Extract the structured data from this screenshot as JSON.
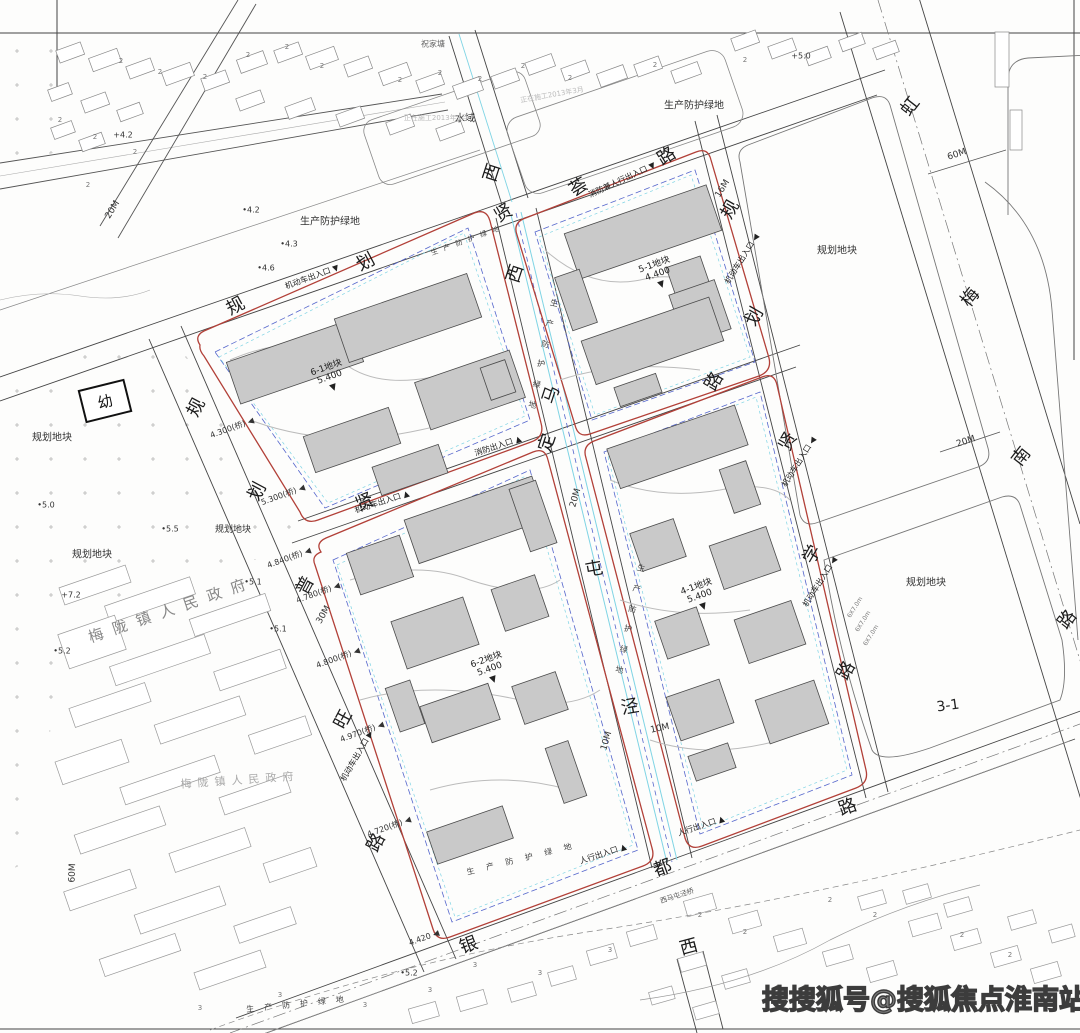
{
  "page": {
    "width": 1080,
    "height": 1033,
    "background": "#fdfdfc"
  },
  "colors": {
    "road_line": "#444444",
    "minor_line": "#999999",
    "plot_red_line": "#b24038",
    "red_dashed": "#8b2e2e",
    "blue_dashed": "#5566cc",
    "cyan_water": "#7fd4e4",
    "building_fill": "#c9c9c9",
    "building_stroke": "#4a4a4a",
    "hatch": "#b5b5b5",
    "watermark_stroke": "#3c3c3c"
  },
  "watermark": {
    "text": "搜搜狐号@搜狐焦点淮南站"
  },
  "kindergarten": {
    "label": "幼"
  },
  "roads": [
    {
      "name": "规划贤荟路",
      "chars": [
        {
          "t": "规",
          "x": 236,
          "y": 307,
          "r": -28
        },
        {
          "t": "划",
          "x": 366,
          "y": 263,
          "r": -28
        },
        {
          "t": "贤",
          "x": 504,
          "y": 214,
          "r": -30
        },
        {
          "t": "荟",
          "x": 579,
          "y": 188,
          "r": -32
        },
        {
          "t": "路",
          "x": 667,
          "y": 157,
          "r": -32
        }
      ]
    },
    {
      "name": "贤定路",
      "chars": [
        {
          "t": "贤",
          "x": 365,
          "y": 503,
          "r": -22
        },
        {
          "t": "定",
          "x": 548,
          "y": 443,
          "r": -72
        },
        {
          "t": "路",
          "x": 715,
          "y": 382,
          "r": -60
        }
      ]
    },
    {
      "name": "规划贤学路",
      "chars": [
        {
          "t": "规",
          "x": 731,
          "y": 210,
          "r": -60
        },
        {
          "t": "划",
          "x": 755,
          "y": 317,
          "r": -60
        },
        {
          "t": "贤",
          "x": 789,
          "y": 442,
          "r": -60
        },
        {
          "t": "学",
          "x": 813,
          "y": 555,
          "r": -60
        },
        {
          "t": "路",
          "x": 847,
          "y": 671,
          "r": -60
        }
      ]
    },
    {
      "name": "规划普旺路",
      "chars": [
        {
          "t": "规",
          "x": 197,
          "y": 408,
          "r": -62
        },
        {
          "t": "划",
          "x": 258,
          "y": 492,
          "r": -62
        },
        {
          "t": "普",
          "x": 306,
          "y": 586,
          "r": -62
        },
        {
          "t": "旺",
          "x": 344,
          "y": 720,
          "r": -62
        },
        {
          "t": "路",
          "x": 377,
          "y": 843,
          "r": -62
        }
      ]
    },
    {
      "name": "银都路",
      "chars": [
        {
          "t": "银",
          "x": 469,
          "y": 946,
          "r": -20
        },
        {
          "t": "都",
          "x": 663,
          "y": 869,
          "r": -20
        },
        {
          "t": "路",
          "x": 848,
          "y": 808,
          "r": -20
        }
      ]
    },
    {
      "name": "虹梅南路",
      "chars": [
        {
          "t": "虹",
          "x": 911,
          "y": 107,
          "r": -52
        },
        {
          "t": "梅",
          "x": 971,
          "y": 298,
          "r": -52
        },
        {
          "t": "南",
          "x": 1022,
          "y": 457,
          "r": -52
        },
        {
          "t": "路",
          "x": 1068,
          "y": 620,
          "r": -52
        }
      ]
    },
    {
      "name": "西马屯泾(河道)",
      "chars": [
        {
          "t": "西",
          "x": 493,
          "y": 173,
          "r": -72
        },
        {
          "t": "西",
          "x": 516,
          "y": 274,
          "r": -72
        },
        {
          "t": "马",
          "x": 552,
          "y": 395,
          "r": -72
        },
        {
          "t": "屯",
          "x": 594,
          "y": 570,
          "r": -10
        },
        {
          "t": "泾",
          "x": 630,
          "y": 708,
          "r": -10
        },
        {
          "t": "西",
          "x": 689,
          "y": 948,
          "r": -15
        }
      ]
    }
  ],
  "plot_markers": [
    {
      "plot": "6-1地块",
      "elev": "5.400",
      "x": 330,
      "y": 378,
      "r": -20
    },
    {
      "plot": "5-1地块",
      "elev": "4.400",
      "x": 658,
      "y": 275,
      "r": -20
    },
    {
      "plot": "6-2地块",
      "elev": "5.400",
      "x": 490,
      "y": 670,
      "r": -20
    },
    {
      "plot": "4-1地块",
      "elev": "5.400",
      "x": 700,
      "y": 597,
      "r": -20
    }
  ],
  "dims": [
    {
      "t": "20M",
      "x": 113,
      "y": 210,
      "r": -58
    },
    {
      "t": "16M",
      "x": 723,
      "y": 189,
      "r": -58
    },
    {
      "t": "60M",
      "x": 957,
      "y": 155,
      "r": -18
    },
    {
      "t": "20M",
      "x": 966,
      "y": 442,
      "r": -18
    },
    {
      "t": "30M",
      "x": 324,
      "y": 615,
      "r": -60
    },
    {
      "t": "20M",
      "x": 576,
      "y": 498,
      "r": -74
    },
    {
      "t": "10M",
      "x": 607,
      "y": 741,
      "r": -74
    },
    {
      "t": "10M",
      "x": 660,
      "y": 729,
      "r": -12
    },
    {
      "t": "60M",
      "x": 73,
      "y": 873,
      "r": -88
    }
  ],
  "entrances": [
    {
      "t": "机动车出入口",
      "x": 312,
      "y": 277,
      "r": -20,
      "arrow": "▼"
    },
    {
      "t": "机动车出入口",
      "x": 382,
      "y": 502,
      "r": -18,
      "arrow": "▲"
    },
    {
      "t": "消防兼人行出入口",
      "x": 622,
      "y": 180,
      "r": -25,
      "arrow": "▼"
    },
    {
      "t": "机动车出入口",
      "x": 742,
      "y": 259,
      "r": -58,
      "arrow": "◀"
    },
    {
      "t": "机动车出入口",
      "x": 799,
      "y": 462,
      "r": -58,
      "arrow": "◀"
    },
    {
      "t": "机动车出入口",
      "x": 820,
      "y": 582,
      "r": -58,
      "arrow": "◀"
    },
    {
      "t": "机动车出入口",
      "x": 357,
      "y": 756,
      "r": -60,
      "arrow": "▶"
    },
    {
      "t": "消防出入口",
      "x": 498,
      "y": 446,
      "r": -18,
      "arrow": "▲"
    },
    {
      "t": "人行出入口",
      "x": 603,
      "y": 854,
      "r": -18,
      "arrow": "▲"
    },
    {
      "t": "人行出入口",
      "x": 701,
      "y": 826,
      "r": -18,
      "arrow": "▲"
    }
  ],
  "elevations": [
    {
      "t": "+5.0",
      "x": 801,
      "y": 56,
      "r": 0
    },
    {
      "t": "+4.2",
      "x": 123,
      "y": 135,
      "r": 0
    },
    {
      "t": "•4.2",
      "x": 251,
      "y": 210,
      "r": 0
    },
    {
      "t": "•4.3",
      "x": 289,
      "y": 244,
      "r": 0
    },
    {
      "t": "•4.6",
      "x": 266,
      "y": 268,
      "r": 0
    },
    {
      "t": "•5.0",
      "x": 46,
      "y": 505,
      "r": 0
    },
    {
      "t": "•5.5",
      "x": 170,
      "y": 529,
      "r": 0
    },
    {
      "t": "+7.2",
      "x": 71,
      "y": 595,
      "r": 0
    },
    {
      "t": "•5.1",
      "x": 253,
      "y": 582,
      "r": 0
    },
    {
      "t": "•5.1",
      "x": 278,
      "y": 629,
      "r": 0
    },
    {
      "t": "•5.2",
      "x": 62,
      "y": 651,
      "r": 0
    },
    {
      "t": "•5.2",
      "x": 409,
      "y": 973,
      "r": 0
    },
    {
      "t": "4.300(桥)",
      "x": 232,
      "y": 428,
      "r": -20,
      "arrow": "◀"
    },
    {
      "t": "5.300(桥)",
      "x": 283,
      "y": 495,
      "r": -20,
      "arrow": "◀"
    },
    {
      "t": "4.840(桥)",
      "x": 289,
      "y": 558,
      "r": -20,
      "arrow": "◀"
    },
    {
      "t": "4.780(桥)",
      "x": 318,
      "y": 593,
      "r": -20,
      "arrow": "◀"
    },
    {
      "t": "4.800(桥)",
      "x": 338,
      "y": 658,
      "r": -20,
      "arrow": "◀"
    },
    {
      "t": "4.970(桥)",
      "x": 362,
      "y": 732,
      "r": -20,
      "arrow": "◀"
    },
    {
      "t": "4.720(桥)",
      "x": 389,
      "y": 827,
      "r": -20,
      "arrow": "◀"
    },
    {
      "t": "4.420",
      "x": 424,
      "y": 938,
      "r": -20,
      "arrow": "◀"
    }
  ],
  "areas": [
    {
      "t": "规划地块",
      "x": 52,
      "y": 438,
      "r": 0,
      "size": 10
    },
    {
      "t": "规划地块",
      "x": 92,
      "y": 555,
      "r": 0,
      "size": 10
    },
    {
      "t": "规划地块",
      "x": 233,
      "y": 530,
      "r": 0,
      "size": 9
    },
    {
      "t": "规划地块",
      "x": 837,
      "y": 251,
      "r": 0,
      "size": 10
    },
    {
      "t": "规划地块",
      "x": 926,
      "y": 583,
      "r": 0,
      "size": 10
    },
    {
      "t": "生产防护绿地",
      "x": 330,
      "y": 222,
      "r": 0,
      "size": 10
    },
    {
      "t": "生产防护绿地",
      "x": 694,
      "y": 106,
      "r": 0,
      "size": 10
    },
    {
      "t": "水域",
      "x": 465,
      "y": 119,
      "r": 0,
      "size": 10
    },
    {
      "t": "祝家塘",
      "x": 433,
      "y": 44,
      "r": 0,
      "size": 8,
      "color": "#666"
    },
    {
      "t": "正在施工2013年3月",
      "x": 436,
      "y": 118,
      "r": 0,
      "size": 7,
      "color": "#bbbbbb"
    },
    {
      "t": "正在施工2013年3月",
      "x": 552,
      "y": 95,
      "r": -10,
      "size": 7,
      "color": "#bbbbbb"
    },
    {
      "t": "梅陇镇人民政府",
      "x": 172,
      "y": 610,
      "r": -19,
      "size": 15,
      "color": "#888888",
      "ls": 10
    },
    {
      "t": "梅陇镇人民政府",
      "x": 240,
      "y": 781,
      "r": -4,
      "size": 11,
      "color": "#aaaaaa",
      "ls": 6
    },
    {
      "t": "西马屯泾桥",
      "x": 677,
      "y": 896,
      "r": -18,
      "size": 7,
      "color": "#555555"
    },
    {
      "t": "3-1",
      "x": 948,
      "y": 706,
      "r": -8,
      "size": 14,
      "color": "#222222"
    },
    {
      "t": "6X7.0m",
      "x": 856,
      "y": 608,
      "r": -58,
      "size": 6,
      "color": "#777777"
    },
    {
      "t": "6X7.0m",
      "x": 864,
      "y": 622,
      "r": -58,
      "size": 6,
      "color": "#777777"
    },
    {
      "t": "6X7.0m",
      "x": 872,
      "y": 636,
      "r": -58,
      "size": 6,
      "color": "#777777"
    }
  ],
  "green_strips": [
    {
      "t": "生产防护绿地",
      "x": 543,
      "y": 355,
      "r": 12,
      "v": true
    },
    {
      "t": "生产防护绿地",
      "x": 630,
      "y": 620,
      "r": 12,
      "v": true
    },
    {
      "t": "生产防护绿地",
      "x": 525,
      "y": 858,
      "r": -14,
      "ls": 12
    },
    {
      "t": "生产防护绿地",
      "x": 300,
      "y": 1004,
      "r": -6,
      "ls": 10
    },
    {
      "t": "生产防护绿地",
      "x": 468,
      "y": 240,
      "r": -20,
      "ls": 6,
      "size": 7
    }
  ],
  "storeys": [
    {
      "t": "2",
      "x": 121,
      "y": 61
    },
    {
      "t": "2",
      "x": 160,
      "y": 72
    },
    {
      "t": "2",
      "x": 205,
      "y": 77
    },
    {
      "t": "2",
      "x": 248,
      "y": 55
    },
    {
      "t": "2",
      "x": 287,
      "y": 47
    },
    {
      "t": "2",
      "x": 322,
      "y": 66
    },
    {
      "t": "2",
      "x": 400,
      "y": 80
    },
    {
      "t": "2",
      "x": 440,
      "y": 73
    },
    {
      "t": "2",
      "x": 480,
      "y": 79
    },
    {
      "t": "2",
      "x": 523,
      "y": 66
    },
    {
      "t": "2",
      "x": 570,
      "y": 78
    },
    {
      "t": "2",
      "x": 655,
      "y": 65
    },
    {
      "t": "2",
      "x": 745,
      "y": 60
    },
    {
      "t": "2",
      "x": 60,
      "y": 120
    },
    {
      "t": "2",
      "x": 95,
      "y": 137
    },
    {
      "t": "2",
      "x": 135,
      "y": 152
    },
    {
      "t": "2",
      "x": 88,
      "y": 185
    },
    {
      "t": "2",
      "x": 700,
      "y": 915
    },
    {
      "t": "2",
      "x": 745,
      "y": 932
    },
    {
      "t": "3",
      "x": 610,
      "y": 950
    },
    {
      "t": "3",
      "x": 540,
      "y": 973
    },
    {
      "t": "3",
      "x": 475,
      "y": 965
    },
    {
      "t": "3",
      "x": 430,
      "y": 990
    },
    {
      "t": "2",
      "x": 830,
      "y": 900
    },
    {
      "t": "2",
      "x": 875,
      "y": 915
    },
    {
      "t": "2",
      "x": 962,
      "y": 935
    },
    {
      "t": "2",
      "x": 1010,
      "y": 955
    },
    {
      "t": "3",
      "x": 280,
      "y": 995
    },
    {
      "t": "3",
      "x": 200,
      "y": 1008
    },
    {
      "t": "3",
      "x": 365,
      "y": 1005
    }
  ]
}
